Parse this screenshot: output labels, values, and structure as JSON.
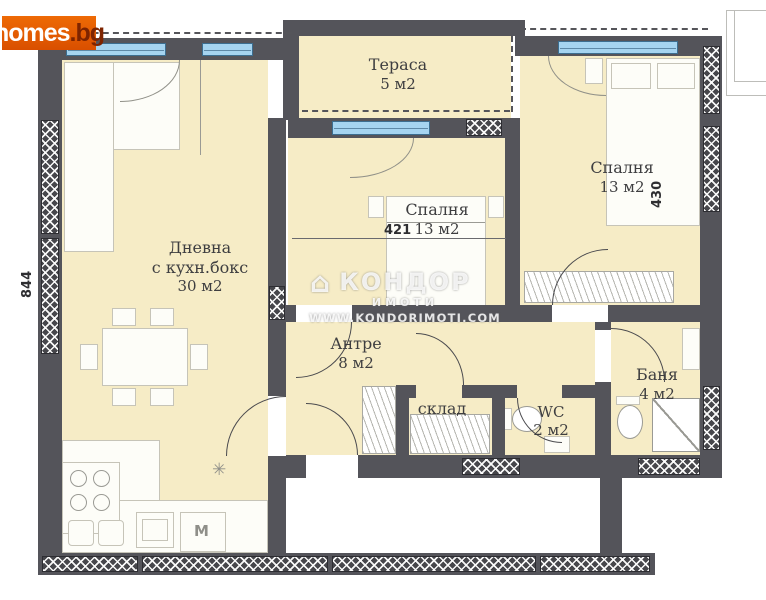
{
  "logo": {
    "brand": "homes",
    "tld": ".bg"
  },
  "watermark": {
    "house_icon": "⌂",
    "line1": "КОНДОР",
    "line2": "ИМОТИ",
    "url": "WWW.KONDORIMOTI.COM"
  },
  "rooms": {
    "terrace": {
      "name": "Тераса",
      "area": "5 м2"
    },
    "bedroom_right": {
      "name": "Спалня",
      "area": "13 м2"
    },
    "bedroom_mid": {
      "name": "Спалня",
      "area": "13 м2"
    },
    "living": {
      "name": "Дневна",
      "name2": "с кухн.бокс",
      "area": "30 м2"
    },
    "antre": {
      "name": "Антре",
      "area": "8 м2"
    },
    "sklad": {
      "name": "склад"
    },
    "wc": {
      "name": "WC",
      "area": "2 м2"
    },
    "bath": {
      "name": "Баня",
      "area": "4 м2"
    }
  },
  "dimensions": {
    "left_wall": "844",
    "bedroom_mid": "421",
    "bedroom_right": "430"
  },
  "symbols": {
    "washing_machine": "М",
    "vent": "✳"
  },
  "colors": {
    "wall": "#54545a",
    "floor": "#f6ecc6",
    "window_glass": "#a5d4f0",
    "logo_orange": "#e85f00",
    "logo_tld": "#7e2400"
  }
}
